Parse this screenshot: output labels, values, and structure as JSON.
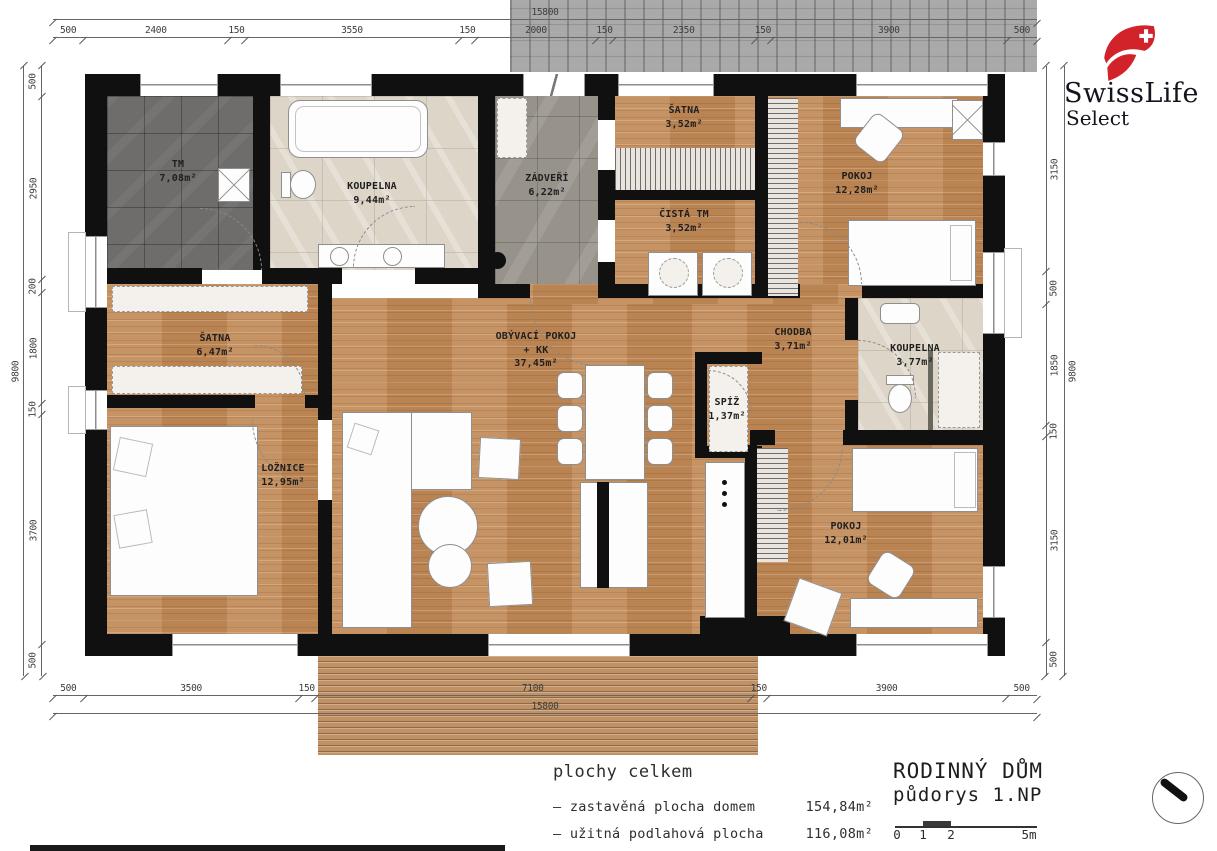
{
  "brand": {
    "name": "SwissLife",
    "sub": "Select"
  },
  "plan": {
    "rooms": [
      {
        "name": "TM",
        "area": "7,08m²"
      },
      {
        "name": "KOUPELNA",
        "area": "9,44m²"
      },
      {
        "name": "ZÁDVEŘÍ",
        "area": "6,22m²"
      },
      {
        "name": "ŠATNA",
        "area": "3,52m²"
      },
      {
        "name": "ČISTÁ TM",
        "area": "3,52m²"
      },
      {
        "name": "POKOJ",
        "area": "12,28m²"
      },
      {
        "name": "ŠATNA",
        "area": "6,47m²"
      },
      {
        "name": "OBÝVACÍ POKOJ",
        "name2": "+  KK",
        "area": "37,45m²"
      },
      {
        "name": "CHODBA",
        "area": "3,71m²"
      },
      {
        "name": "KOUPELNA",
        "area": "3,77m²"
      },
      {
        "name": "SPÍŽ",
        "area": "1,37m²"
      },
      {
        "name": "LOŽNICE",
        "area": "12,95m²"
      },
      {
        "name": "POKOJ",
        "area": "12,01m²"
      }
    ]
  },
  "dimensions": {
    "top_total": [
      "15800"
    ],
    "top": [
      "500",
      "2400",
      "150",
      "3550",
      "150",
      "2000",
      "150",
      "2350",
      "150",
      "3900",
      "500"
    ],
    "bottom": [
      "500",
      "3500",
      "150",
      "7100",
      "150",
      "3900",
      "500"
    ],
    "bottom_total": [
      "15800"
    ],
    "left": [
      "500",
      "2950",
      "200",
      "1800",
      "150",
      "3700",
      "500"
    ],
    "left_total": [
      "9800"
    ],
    "right": [
      "3150",
      "500",
      "1850",
      "150",
      "3150",
      "500"
    ],
    "right_total": [
      "9800"
    ]
  },
  "legend": {
    "heading": "plochy celkem",
    "items": [
      {
        "label": "– zastavěná plocha domem",
        "value": "154,84m²"
      },
      {
        "label": "– užitná podlahová plocha",
        "value": "116,08m²"
      }
    ]
  },
  "titleblock": {
    "project": "RODINNÝ DŮM",
    "drawing": "půdorys 1.NP",
    "scale_ticks": [
      "0",
      "1",
      "2",
      "5m"
    ]
  },
  "colors": {
    "wood": "#c28b59",
    "tile_dark": "#6e6d6b",
    "tile_grey": "#97938b",
    "marble": "#ddd6c8",
    "wall": "#101010",
    "brand_red": "#d2232a"
  }
}
